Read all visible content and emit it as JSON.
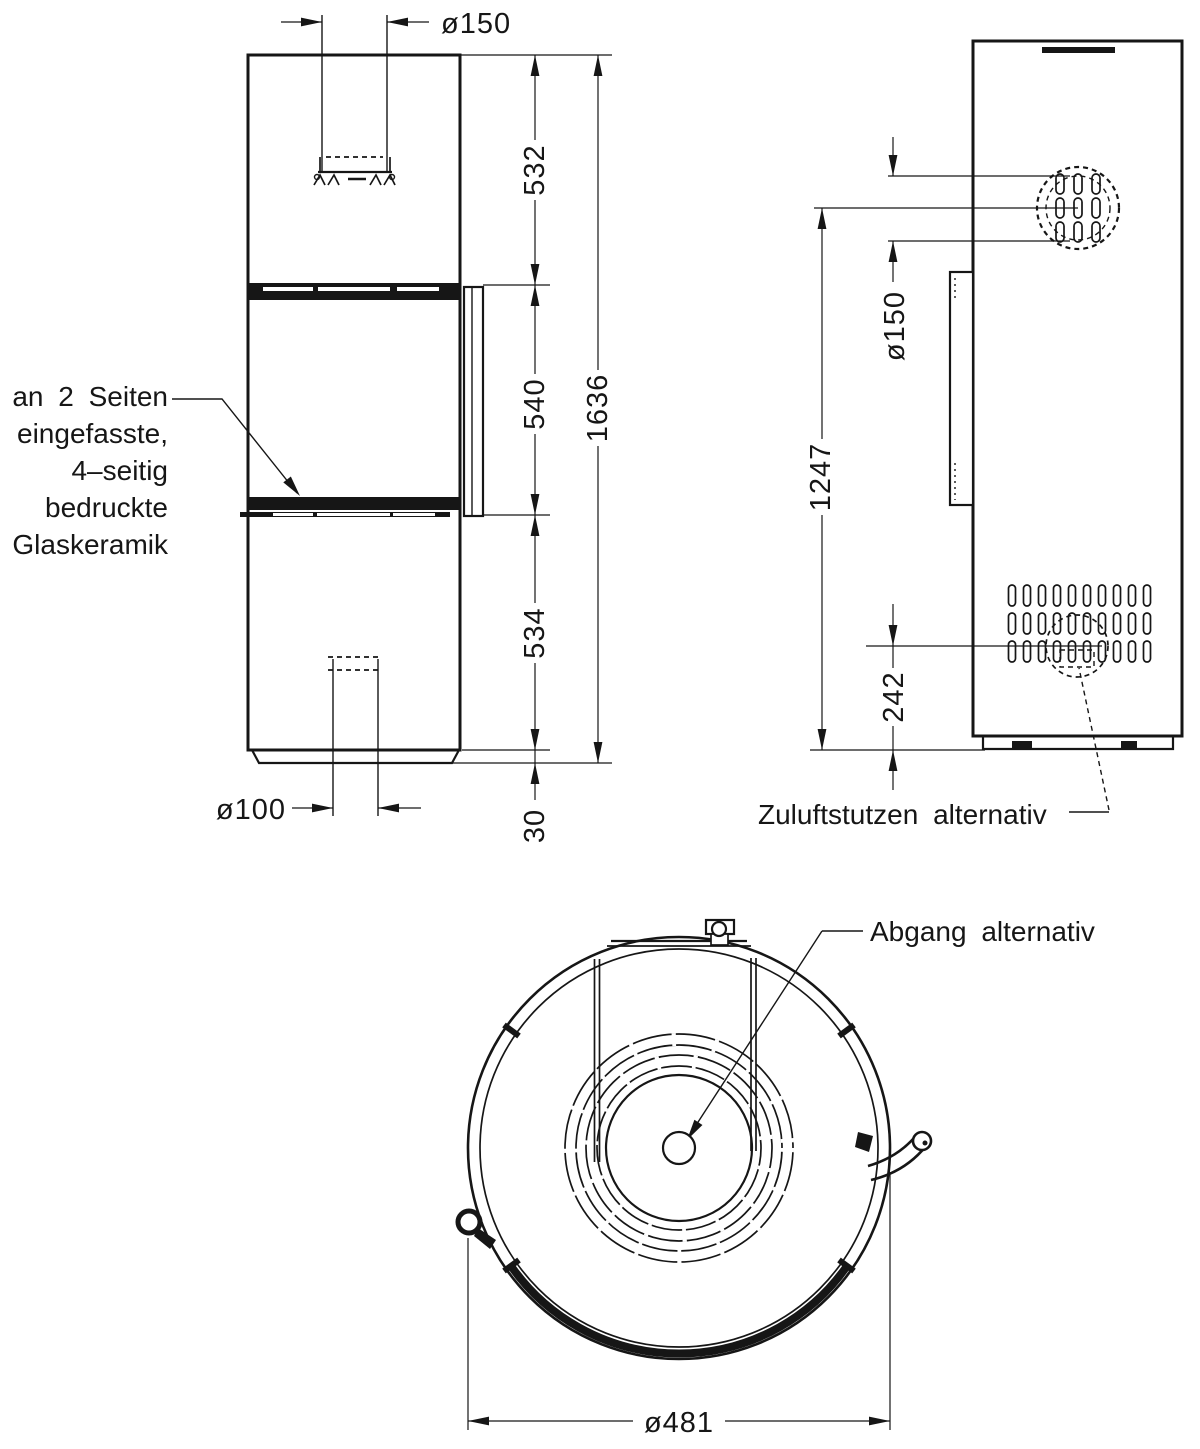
{
  "front_view": {
    "flue_dia": "ø150",
    "dim_top": "532",
    "dim_window": "540",
    "dim_lower": "534",
    "dim_base": "30",
    "dim_total": "1636",
    "inlet_dia": "ø100",
    "glass_note": [
      "an 2 Seiten",
      "eingefasste,",
      "4–seitig",
      "bedruckte",
      "Glaskeramik"
    ]
  },
  "side_view": {
    "flue_dia": "ø150",
    "dim_flue_height": "1247",
    "dim_inlet_height": "242",
    "inlet_note": "Zuluftstutzen alternativ"
  },
  "top_view": {
    "outlet_note": "Abgang alternativ",
    "dim_dia": "ø481"
  },
  "colors": {
    "line": "#161616",
    "background": "#ffffff"
  }
}
